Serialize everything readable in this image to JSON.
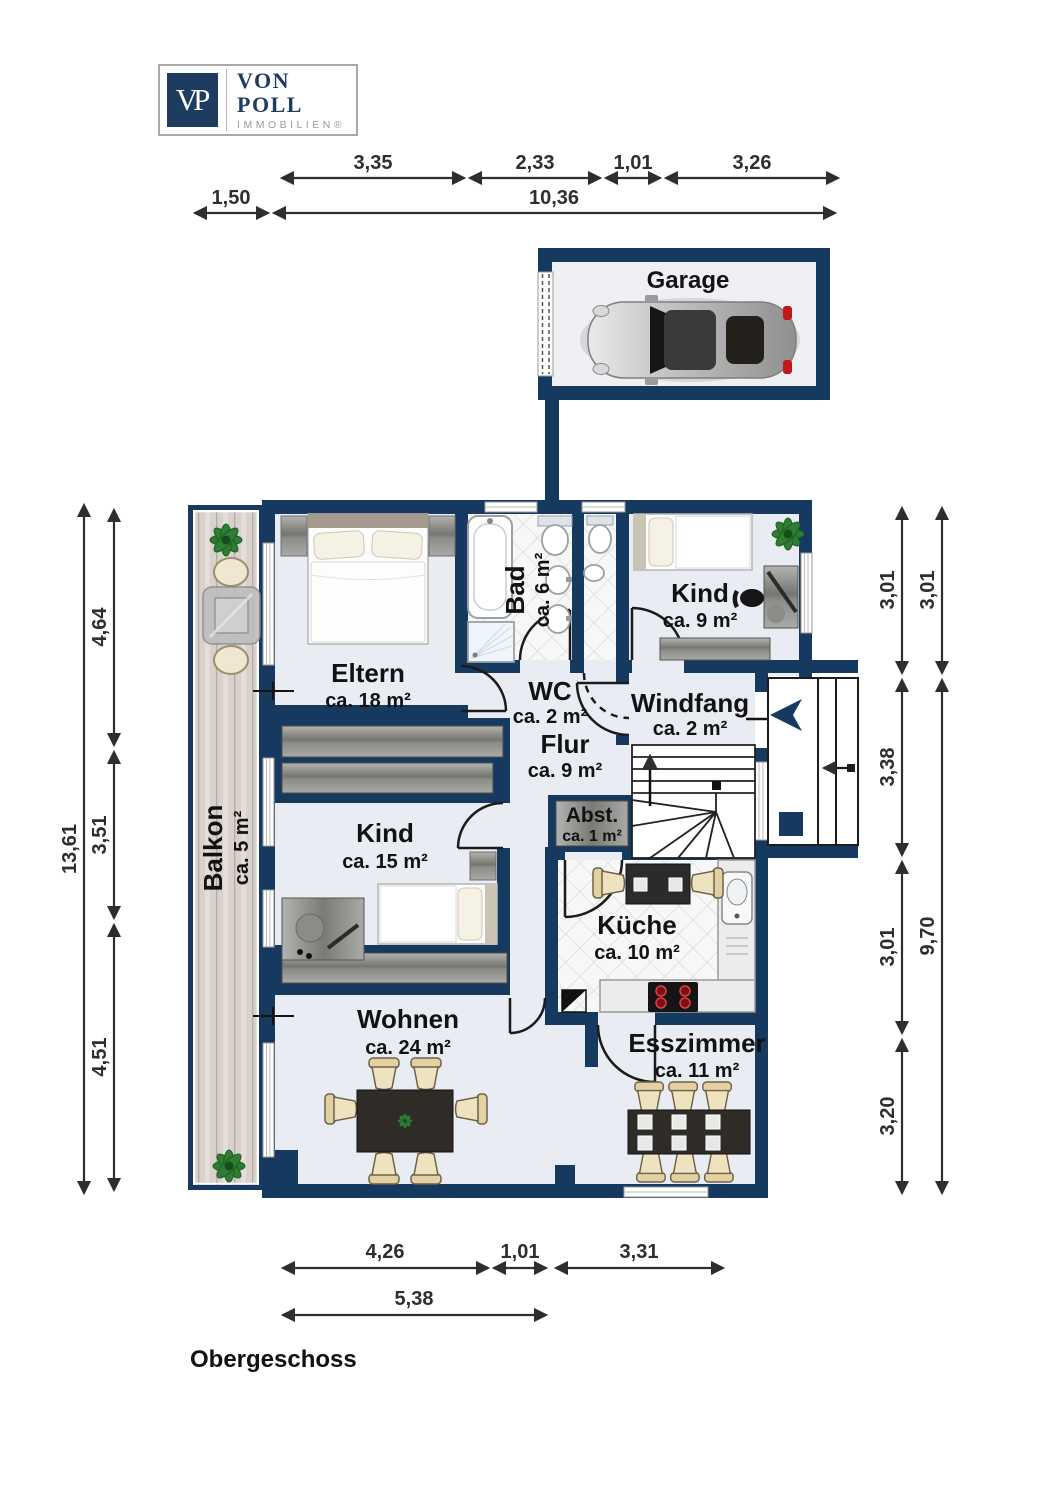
{
  "logo": {
    "monogram": "VP",
    "brand": "VON POLL",
    "subtitle": "IMMOBILIEN®"
  },
  "floor_label": "Obergeschoss",
  "garage": {
    "label": "Garage"
  },
  "rooms": {
    "eltern": {
      "name": "Eltern",
      "area": "ca. 18 m²"
    },
    "bad": {
      "name": "Bad",
      "area": "ca. 6 m²"
    },
    "kind9": {
      "name": "Kind",
      "area": "ca. 9 m²"
    },
    "wc": {
      "name": "WC",
      "area": "ca. 2 m²"
    },
    "windfang": {
      "name": "Windfang",
      "area": "ca. 2 m²"
    },
    "flur": {
      "name": "Flur",
      "area": "ca. 9 m²"
    },
    "abst": {
      "name": "Abst.",
      "area": "ca. 1 m²"
    },
    "kueche": {
      "name": "Küche",
      "area": "ca. 10 m²"
    },
    "kind15": {
      "name": "Kind",
      "area": "ca. 15 m²"
    },
    "wohnen": {
      "name": "Wohnen",
      "area": "ca. 24 m²"
    },
    "esszimmer": {
      "name": "Esszimmer",
      "area": "ca. 11 m²"
    },
    "balkon": {
      "name": "Balkon",
      "area": "ca. 5 m²"
    }
  },
  "dims": {
    "top_1": "3,35",
    "top_2": "2,33",
    "top_3": "1,01",
    "top_4": "3,26",
    "top_left": "1,50",
    "top_total": "10,36",
    "left_total": "13,61",
    "left_1": "4,64",
    "left_2": "3,51",
    "left_3": "4,51",
    "right_1": "3,01",
    "right_2": "3,38",
    "right_3": "3,01",
    "right_4": "3,20",
    "right_outer_1": "3,01",
    "right_outer_total": "9,70",
    "bottom_1": "4,26",
    "bottom_2": "1,01",
    "bottom_3": "3,31",
    "bottom_total": "5,38"
  },
  "colors": {
    "wall_navy": "#163a5f",
    "floor": "#e9ecf3",
    "tile_bg": "#f7f7f8",
    "tile_line": "#dcdcdc",
    "balcony_wood": "#d8d1cc",
    "dim_line": "#2e2e2e",
    "chair_beige": "#ecdcb4",
    "table_dark": "#2f2c28",
    "burner_red": "#b3121a",
    "logo_navy": "#1d3c60",
    "logo_gray": "#9a9a9a"
  }
}
